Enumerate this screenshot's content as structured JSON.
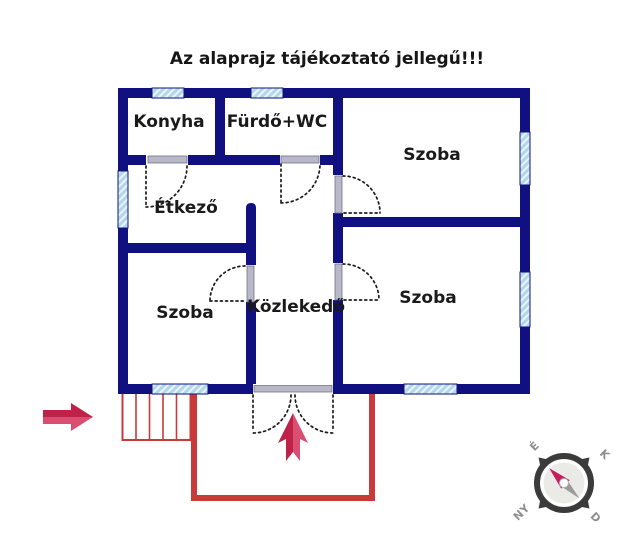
{
  "title": "Az alaprajz tájékoztató jellegű!!!",
  "rooms": {
    "konyha": "Konyha",
    "furdo_wc": "Fürdő+WC",
    "szoba_top_right": "Szoba",
    "etkezo": "Étkező",
    "szoba_bottom_left": "Szoba",
    "kozlekedo": "Közlekedő",
    "szoba_bottom_right": "Szoba"
  },
  "compass": {
    "north": "É",
    "east": "K",
    "west": "NY",
    "south": "D"
  },
  "colors": {
    "wall_navy": "#101080",
    "window_blue": "#b3d7ea",
    "window_stripe": "#e9f4fa",
    "door_jamb_gray": "#b9b8c9",
    "terrace_red": "#c93a3a",
    "arrow_crimson_dark": "#c02149",
    "arrow_crimson_light": "#d94e71",
    "compass_ring_gray": "#3b3b3b",
    "compass_needle_pink": "#c81d5c",
    "compass_needle_gray": "#9b9b9b",
    "label_black": "#1a1a1a"
  }
}
